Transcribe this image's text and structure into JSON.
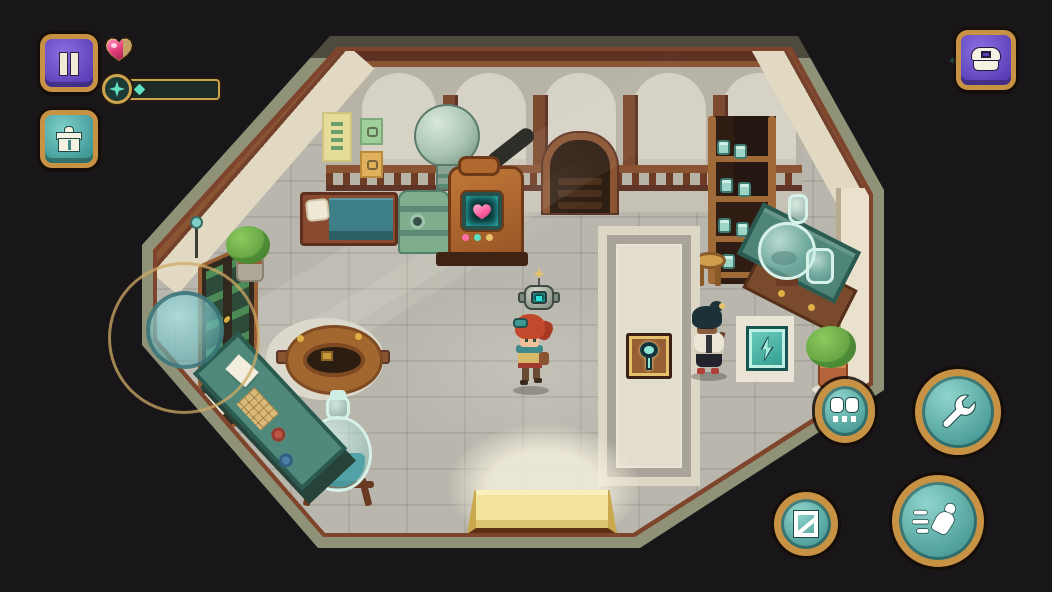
{
  "hud": {
    "pause_button": {
      "icon": "pause-icon"
    },
    "health": {
      "total": 6,
      "full": 5,
      "partial_fraction": 0.65,
      "heart_color": "#e23a77",
      "empty_color": "#c6a364",
      "border_color": "#c9a24a"
    },
    "energy": {
      "pips": 5,
      "pip_color": "#5fe0c0",
      "cap_icon": "four-point-star-icon"
    },
    "inventory_button": {
      "icon": "gift-icon"
    },
    "currency": {
      "amount": "305",
      "gem_color": "#63e0cf",
      "chest_button_icon": "chest-icon"
    }
  },
  "controls": {
    "joystick": {
      "ring_color": "#cdaa64",
      "knob_color": "#6fb7ba"
    },
    "action_buttons": [
      {
        "name": "wrench-button",
        "icon": "wrench-icon"
      },
      {
        "name": "dash-button",
        "icon": "runner-icon"
      },
      {
        "name": "map-button",
        "icon": "map-icon"
      },
      {
        "name": "companion-button",
        "icon": "goggle-eyes-icon"
      }
    ]
  },
  "scene": {
    "room": {
      "floor_color": "#b9b6ad",
      "wall_color": "#ece4d0",
      "rim_color": "#8f9276",
      "trim_color": "#7e452c"
    },
    "display_mat": {
      "items": [
        {
          "name": "heart-patch-plaque",
          "icon": "heart-patch-icon"
        },
        {
          "name": "bolt-patch-plaque",
          "icon": "bolt-patch-icon"
        },
        {
          "name": "key-patch-plaque",
          "icon": "key-patch-icon"
        }
      ]
    },
    "floor_patch": {
      "icon": "bolt-icon",
      "color": "#49b8a8"
    },
    "machine_screen": {
      "icon": "heart-icon",
      "glow_color": "#2de0d8"
    },
    "characters": [
      "player-hero",
      "shopkeeper-npc",
      "robot-companion"
    ]
  }
}
